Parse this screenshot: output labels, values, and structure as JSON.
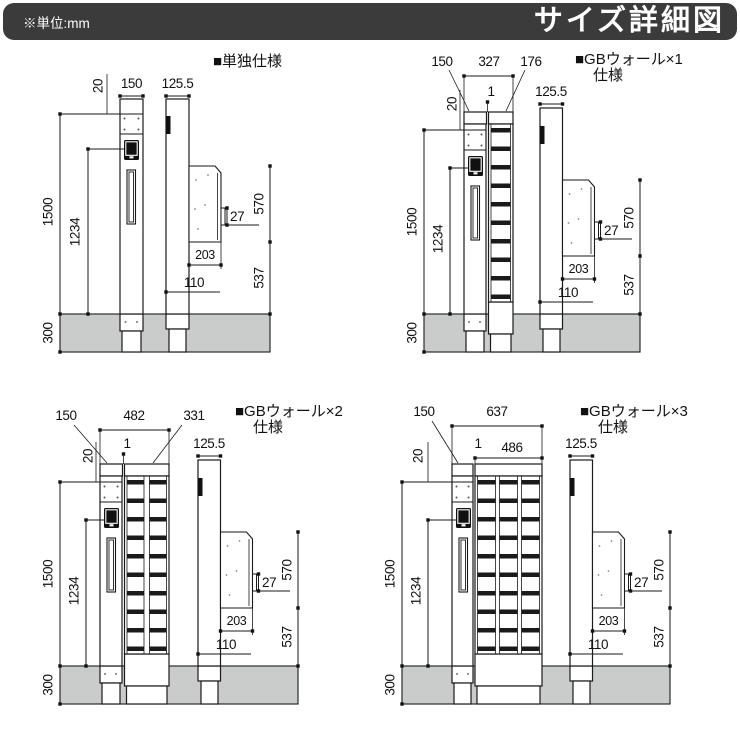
{
  "header": {
    "unit_note": "※単位:mm",
    "title": "サイズ詳細図"
  },
  "colors": {
    "header_bg": "#3b3b3b",
    "line": "#1a1a1a",
    "ground": "#cacccb"
  },
  "quadrants": {
    "q1": {
      "label": "■単独仕様",
      "dims": {
        "post_w": "150",
        "side_w": "125.5",
        "top": "20",
        "total_h": "1500",
        "device_h": "1234",
        "bracket": "27",
        "panel_h": "570",
        "panel_d": "203",
        "clear": "110",
        "lower_h": "537",
        "embed": "300"
      }
    },
    "q2": {
      "label": "■GBウォール×1",
      "label2": "仕様",
      "dims": {
        "post_w": "150",
        "overall": "327",
        "wall_w": "176",
        "gap": "1",
        "side_w": "125.5",
        "top": "20",
        "total_h": "1500",
        "device_h": "1234",
        "bracket": "27",
        "panel_h": "570",
        "panel_d": "203",
        "clear": "110",
        "lower_h": "537",
        "embed": "300"
      }
    },
    "q3": {
      "label": "■GBウォール×2",
      "label2": "仕様",
      "dims": {
        "post_w": "150",
        "overall": "482",
        "wall_w": "331",
        "gap": "1",
        "side_w": "125.5",
        "top": "20",
        "total_h": "1500",
        "device_h": "1234",
        "bracket": "27",
        "panel_h": "570",
        "panel_d": "203",
        "clear": "110",
        "lower_h": "537",
        "embed": "300"
      }
    },
    "q4": {
      "label": "■GBウォール×3",
      "label2": "仕様",
      "dims": {
        "post_w": "150",
        "overall": "637",
        "wall_w": "486",
        "gap": "1",
        "side_w": "125.5",
        "top": "20",
        "total_h": "1500",
        "device_h": "1234",
        "bracket": "27",
        "panel_h": "570",
        "panel_d": "203",
        "clear": "110",
        "lower_h": "537",
        "embed": "300"
      }
    }
  }
}
